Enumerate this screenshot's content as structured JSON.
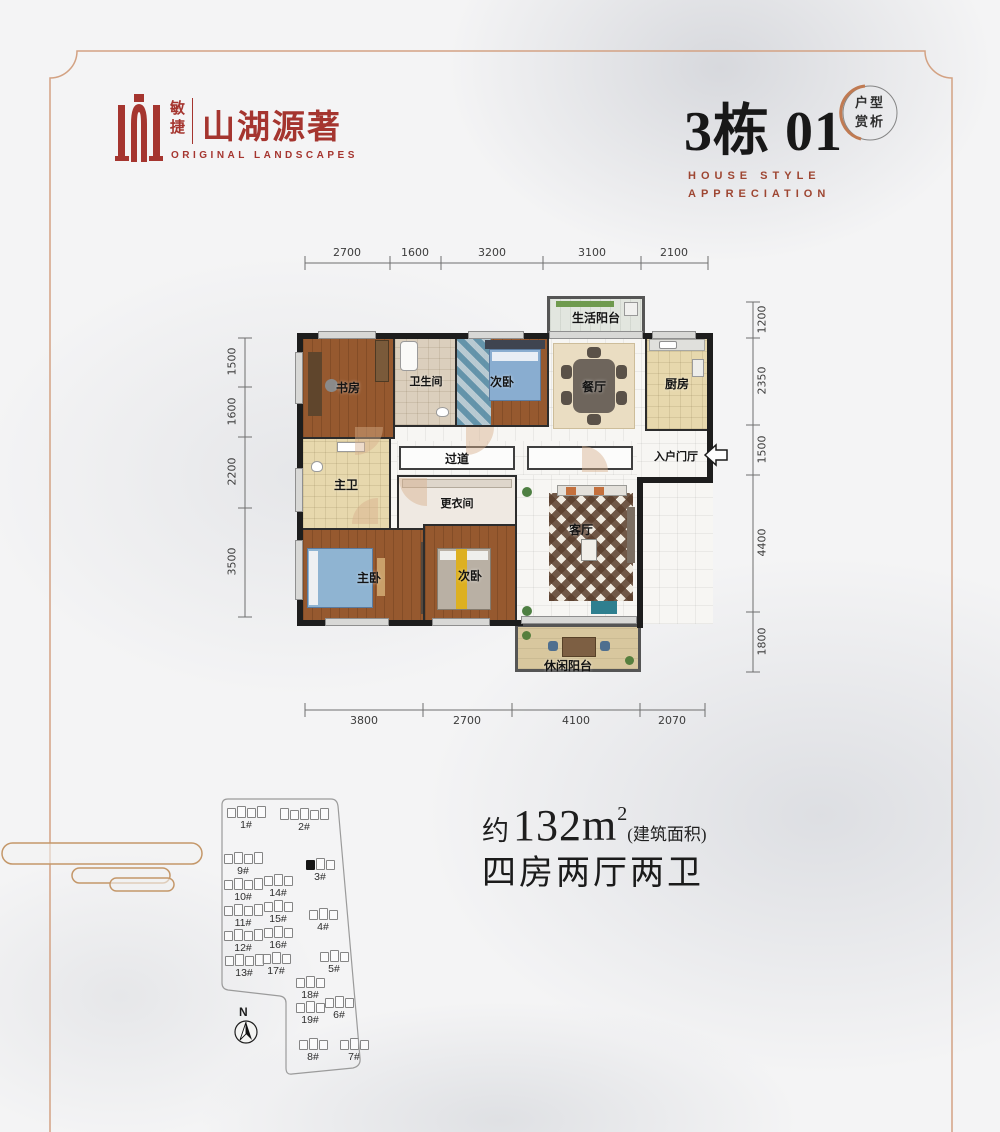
{
  "colors": {
    "brand_red": "#a5352f",
    "maroon_subtitle": "#9e4632",
    "copper_frame": "#d3a283",
    "badge_arc": "#c07a52",
    "wall_black": "#1d1d1d",
    "wood_floor": "#96592f",
    "marble_bg": "#f4f4f5"
  },
  "header": {
    "logo": {
      "brand_small": "敏捷",
      "brand_name": "山湖源著",
      "brand_en": "ORIGINAL LANDSCAPES"
    },
    "unit_title": "3栋 01",
    "subtitle_line1": "HOUSE STYLE",
    "subtitle_line2": "APPRECIATION",
    "badge": {
      "line1": "户型",
      "line2": "赏析"
    }
  },
  "floorplan": {
    "dims_top": [
      "2700",
      "1600",
      "3200",
      "3100",
      "2100"
    ],
    "dims_left": [
      "1500",
      "1600",
      "2200",
      "3500"
    ],
    "dims_right": [
      "1200",
      "2350",
      "1500",
      "4400",
      "1800"
    ],
    "dims_bottom": [
      "3800",
      "2700",
      "4100",
      "2070"
    ],
    "rooms": {
      "life_balcony": "生活阳台",
      "study": "书房",
      "bathroom": "卫生间",
      "bedroom_top": "次卧",
      "dining": "餐厅",
      "kitchen": "厨房",
      "corridor": "过道",
      "entry": "入户门厅",
      "master_bath": "主卫",
      "closet": "更衣间",
      "master_bedroom": "主卧",
      "bedroom_bottom": "次卧",
      "living": "客厅",
      "leisure_balcony": "休闲阳台"
    }
  },
  "info": {
    "area_prefix": "约",
    "area_value": "132m",
    "area_sup": "2",
    "area_note": "(建筑面积)",
    "layout_text": "四房两厅两卫"
  },
  "siteplan": {
    "compass_label": "N",
    "buildings": [
      {
        "label": "1#"
      },
      {
        "label": "2#"
      },
      {
        "label": "9#"
      },
      {
        "label": "3#",
        "highlight": true
      },
      {
        "label": "14#"
      },
      {
        "label": "10#"
      },
      {
        "label": "15#"
      },
      {
        "label": "4#"
      },
      {
        "label": "11#"
      },
      {
        "label": "16#"
      },
      {
        "label": "12#"
      },
      {
        "label": "17#"
      },
      {
        "label": "13#"
      },
      {
        "label": "5#"
      },
      {
        "label": "18#"
      },
      {
        "label": "19#"
      },
      {
        "label": "6#"
      },
      {
        "label": "8#"
      },
      {
        "label": "7#"
      }
    ]
  }
}
